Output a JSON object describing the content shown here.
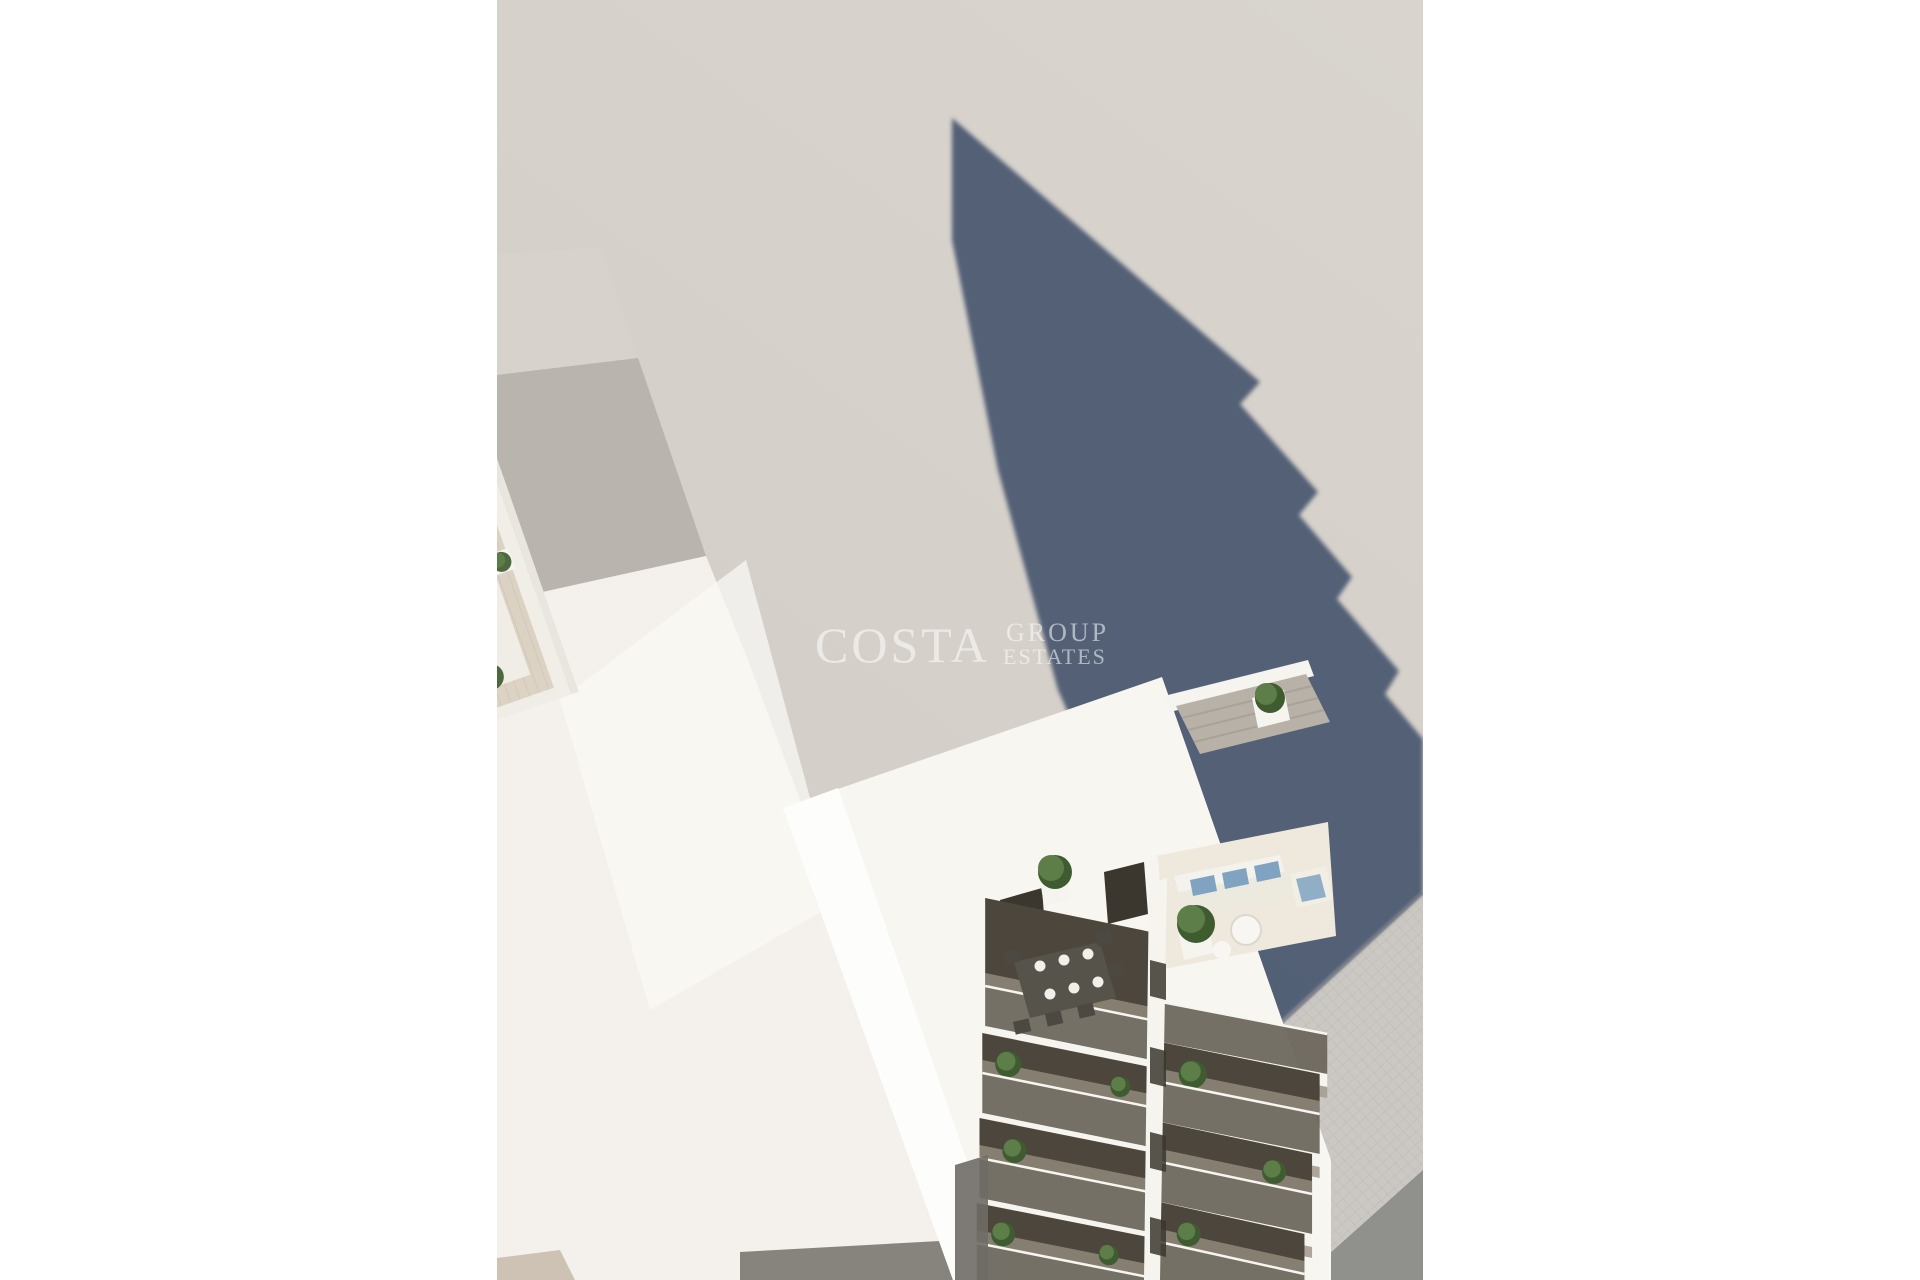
{
  "meta": {
    "description": "Aerial 3D architectural render of a new-build apartment tower with rooftop swimming pool, sun deck, lounge furniture and stacked glass balconies, casting a long shadow onto the street"
  },
  "watermark": {
    "line1": "COSTA",
    "line2": "GROUP",
    "line3": "ESTATES"
  },
  "scene": {
    "roof_loungers": 6,
    "roof_plants": 12,
    "left_balcony_floors": 4,
    "right_balcony_floors": 4
  },
  "colors": {
    "page_bg": "#ffffff",
    "photo_bg": "#d5cfc9",
    "photo_bg_light": "#dad5cf",
    "shadow_color": "#47566f",
    "walk_shadow": "rgba(64,76,104,0.5)",
    "building_white": "#f8f6f1",
    "wall_bright": "#fdfdfb",
    "wall_shade": "#e9e6e0",
    "roof_floor": "#f0ede7",
    "deck": "#ddd3c4",
    "deck_line": "#cdc2b0",
    "pool_blue": "#41b4e9",
    "pool_light": "#74ccf2",
    "pool_deep": "#2487cb",
    "coping": "#f6f7f7",
    "chimney": "#2a2c30",
    "chimney_dark": "#17191c",
    "plant_green": "#5d7d49",
    "plant_dark": "#3f5c31",
    "planter": "#f6f4ef",
    "lounger": "#f2efe8",
    "balcony_interior": "#4d463d",
    "glass": "#6b655b",
    "slab": "#f6f4ef",
    "underside": "#a59d93",
    "neighbor_light": "#d7d2cb",
    "neighbor_mid": "#b9b4ad",
    "neighbor_wall": "#f4f1ec",
    "sidewalk": "#cbc8c3",
    "sidewalk_line": "#b9b6b0",
    "road": "#90908d",
    "door_dark": "#3b372f",
    "table_dark": "#55534a",
    "blue_cushion": "#7fa3c0",
    "railing_black": "#2b2a24",
    "watermark_color": "rgba(255,255,255,0.55)"
  }
}
